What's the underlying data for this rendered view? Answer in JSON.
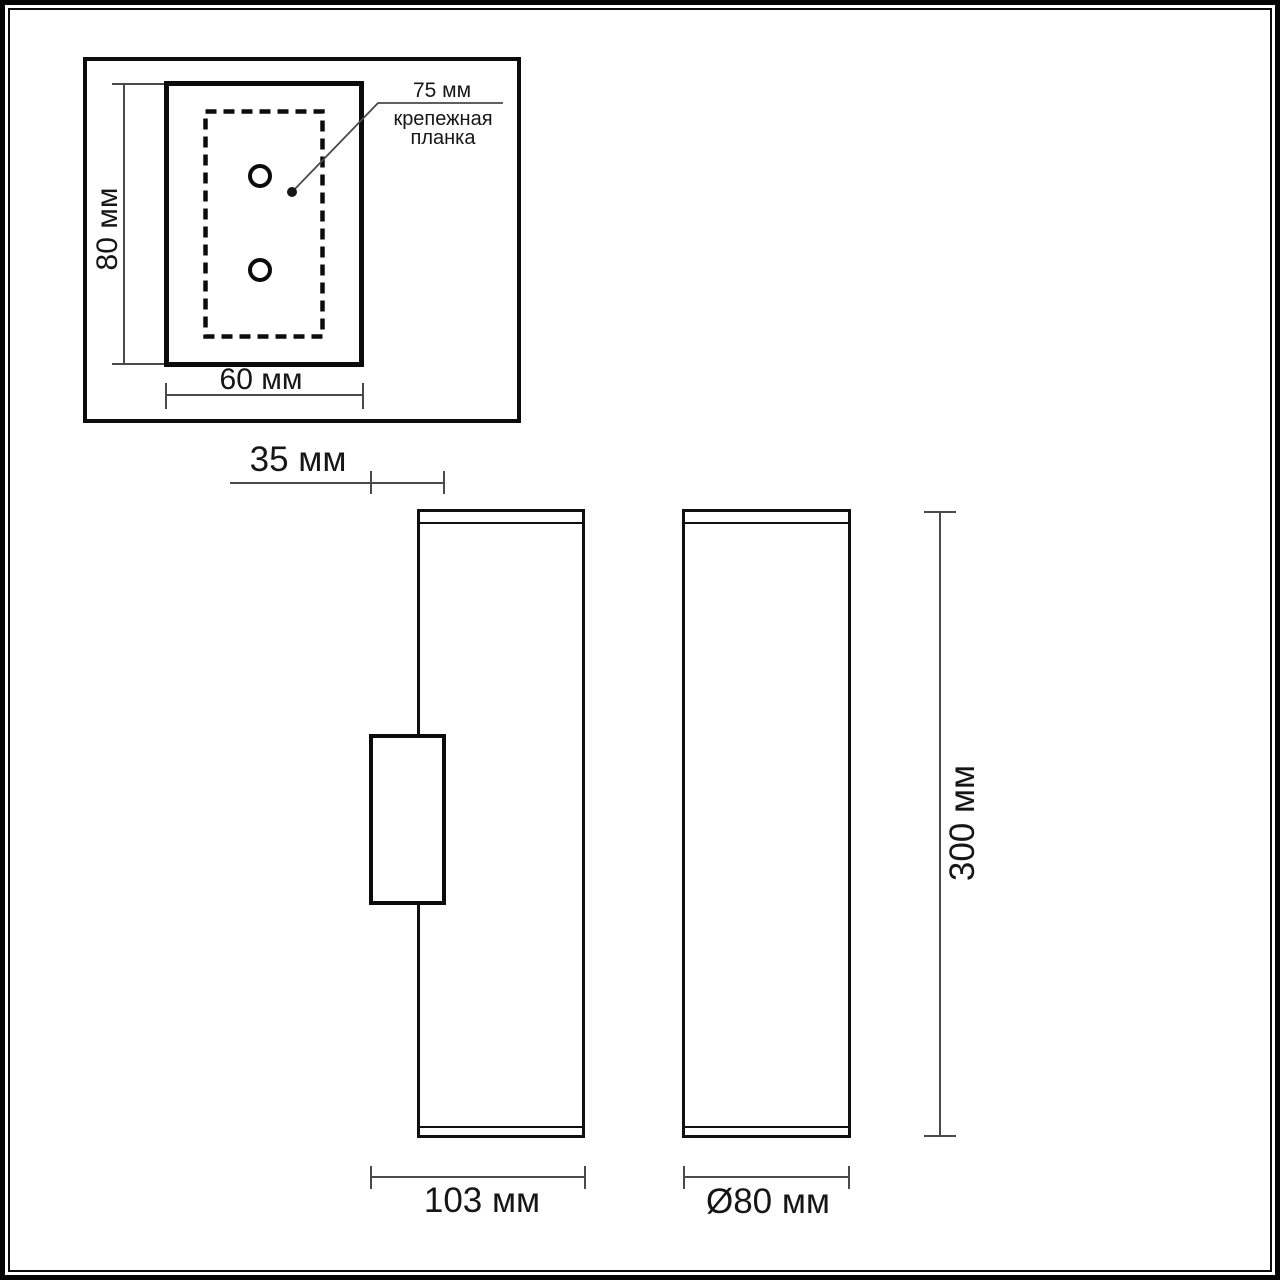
{
  "drawing": {
    "detail_view": {
      "plate_height_label": "80 мм",
      "plate_width_label": "60 мм",
      "hole_spacing_label": "75 мм",
      "caption_line1": "крепежная",
      "caption_line2": "планка"
    },
    "side_view": {
      "bracket_depth_label": "35 мм",
      "body_depth_label": "103 мм"
    },
    "front_view": {
      "body_height_label": "300 мм",
      "body_diameter_label": "Ø80 мм"
    },
    "colors": {
      "drawing_line": "#0c0c0c",
      "dimension_line": "#4a4a4a",
      "background": "#ffffff"
    }
  }
}
